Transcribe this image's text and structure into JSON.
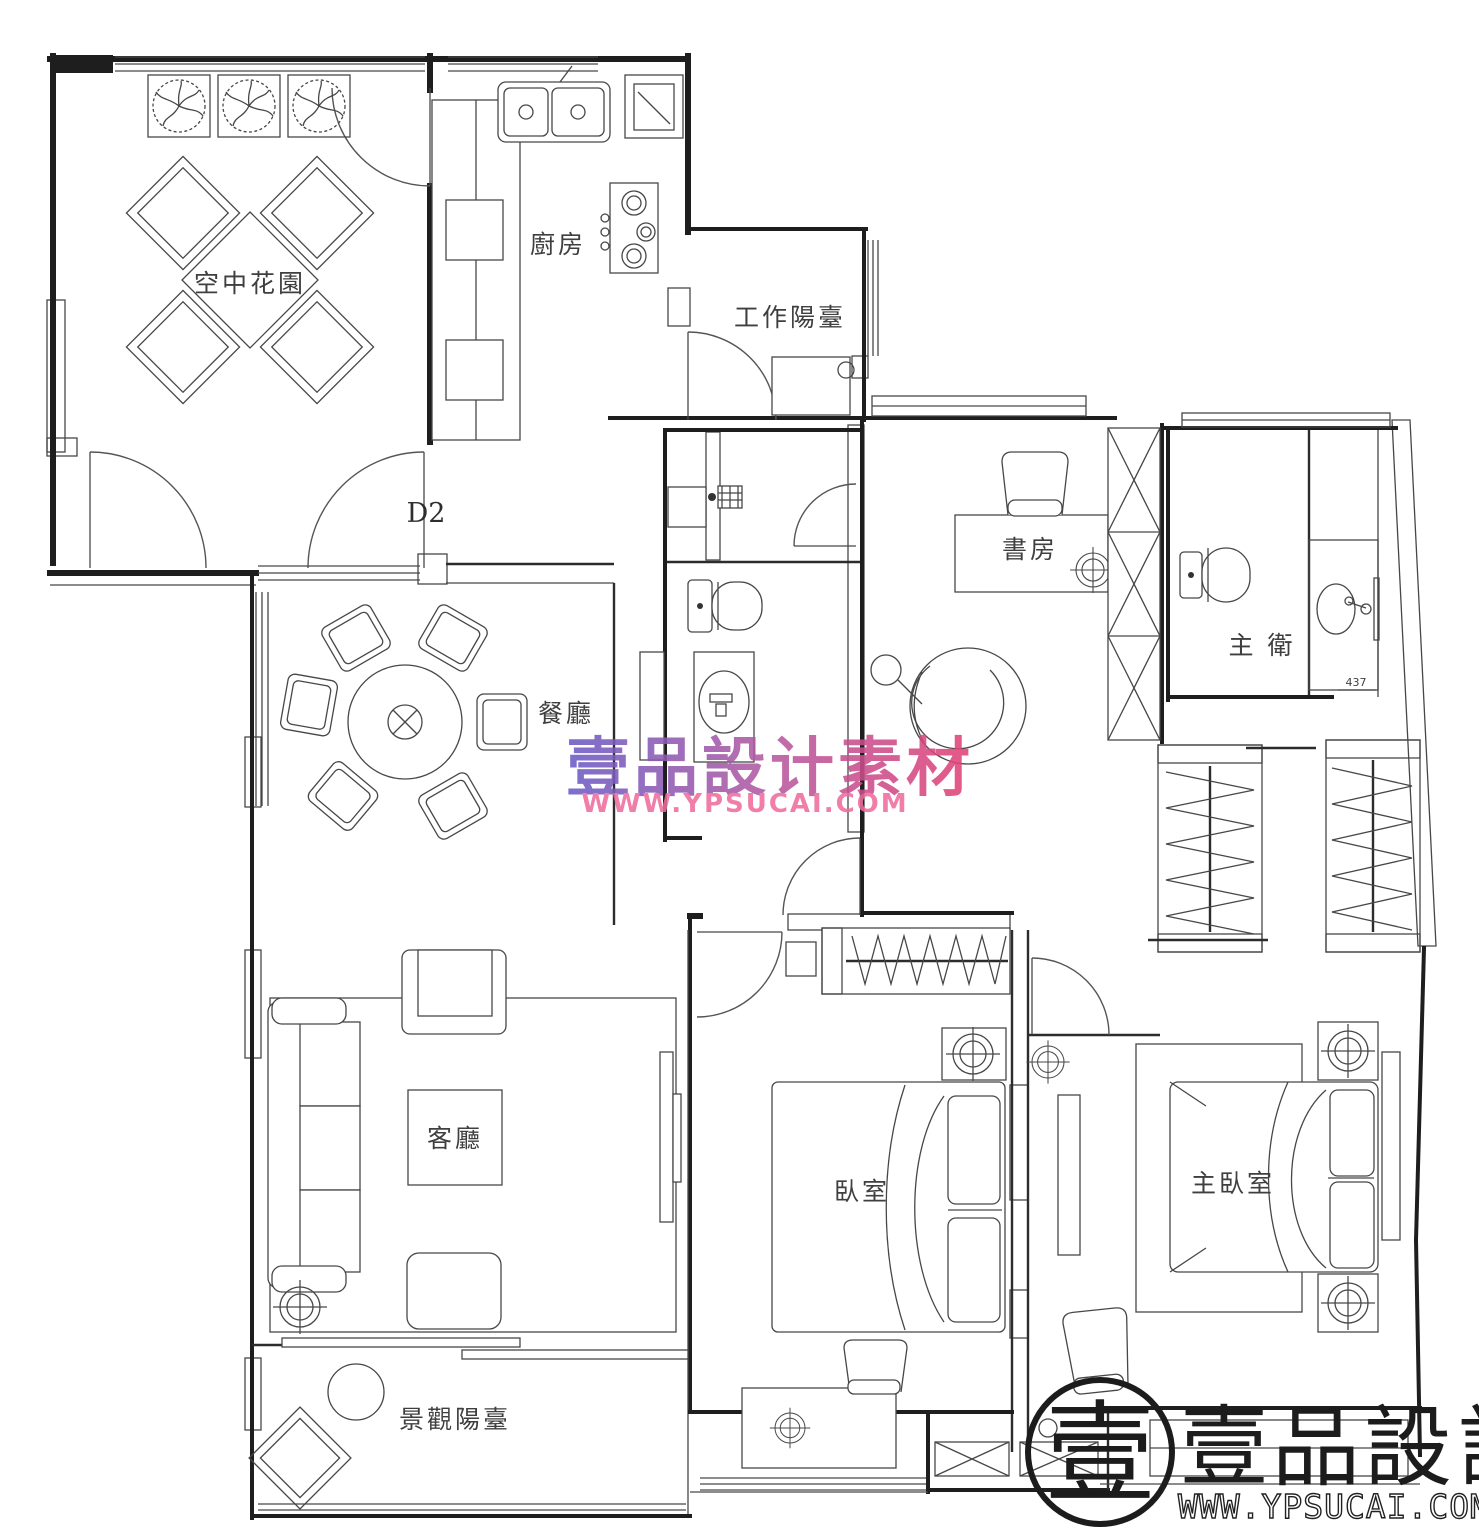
{
  "document": {
    "kind_label": "residential floor plan"
  },
  "rooms": {
    "sky_garden": "空中花園",
    "kitchen": "廚房",
    "work_balcony": "工作陽臺",
    "study": "書房",
    "master_bath": "主 衛",
    "dining": "餐廳",
    "living": "客廳",
    "bedroom": "臥室",
    "master_bedroom": "主臥室",
    "view_balcony": "景觀陽臺"
  },
  "annotations": {
    "door_code": "D2",
    "dimension_437": "437"
  },
  "watermark": {
    "brand": "壹品設计素材",
    "site": "WWW.YPSUCAI.COM",
    "color_left": "#6a5cc6",
    "color_mid": "#b559a0",
    "color_right": "#e34276",
    "site_color": "#ee6d9d"
  },
  "logo": {
    "seal_char": "壹",
    "brand": "壹品設計",
    "site": "WWW.YPSUCAI.COM",
    "ink": "#1c1c1c"
  },
  "canvas": {
    "bg": "#ffffff",
    "line": "#2b2b2b"
  }
}
